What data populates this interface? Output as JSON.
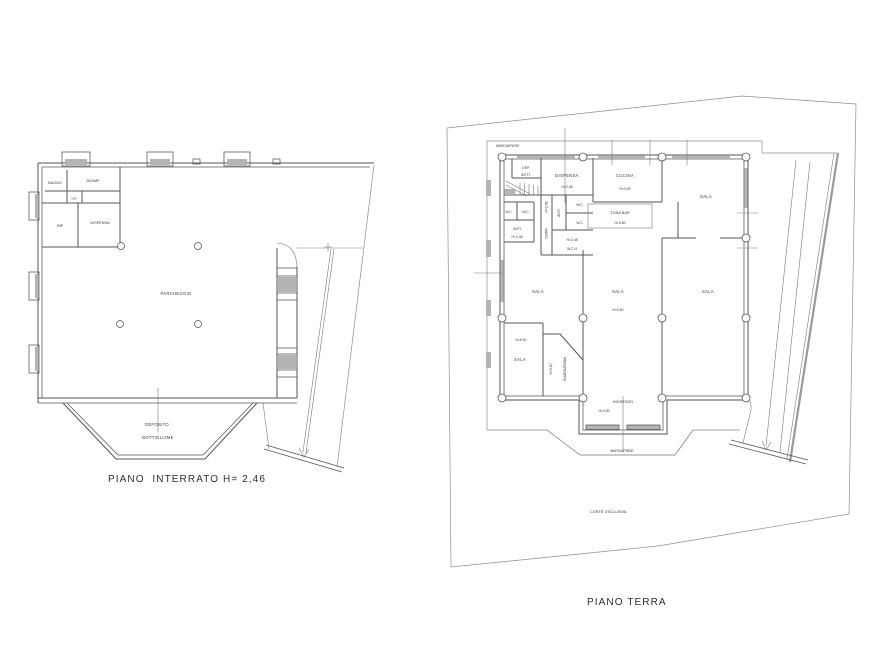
{
  "title": "Floor plan drawing",
  "colors": {
    "background": "#ffffff",
    "line": "#565656",
    "boundary": "#8f8f8f",
    "hatch_fill": "#b4b4b4",
    "text": "#383838"
  },
  "basement_plan": {
    "caption": "PIANO  INTERRATO H= 2,46",
    "rooms": {
      "bagno": "BAGNO",
      "disimp": "DISIMP",
      "dis": "DIS",
      "rip": "RIP",
      "dispensa": "DISPENSA",
      "parcheggio": "PARCHEGGIO",
      "deposito_line1": "DEPOSITO",
      "deposito_line2": "BOTTIGLIAME"
    }
  },
  "ground_plan": {
    "caption": "PIANO TERRA",
    "site": {
      "marciapiede_top": "MARCIAPIEDE",
      "marciapiede_bottom": "MARCIAPIEDE",
      "corte_esclusiva": "CORTE  ESCLUSIVA"
    },
    "rooms": {
      "dep_line1": "DEP.",
      "dep_line2": "BOTT.",
      "dispensa": "DISPENSA",
      "dispensa_h": "H=2,48",
      "cucina": "CUCINA",
      "cucina_h": "H=3,09",
      "sala_ne": "SALA",
      "zona_bar": "ZONA BAR",
      "zona_bar_h": "H=5,60",
      "wc_a": "W.C.",
      "wc_b": "W.C.",
      "wc_c": "W.C.",
      "wc_d": "W.C.",
      "anti_vertical": "ANTI",
      "corr_h": "H=2,48",
      "corr": "CORR.",
      "anti": "ANTI",
      "anti_h": "H=2,48",
      "wch_h": "H=2,48",
      "wch": "W.C.H",
      "sala_w": "SALA",
      "sala_c": "SALA",
      "sala_c_h": "H=5,60",
      "sala_e": "SALA",
      "sala_sw_h": "H=5,60",
      "sala_sw": "SALA",
      "guardaroba_h": "H=5,60",
      "guardaroba": "GUARDAROBA",
      "ingresso": "INGRESSO",
      "ingresso_h": "H=3,90"
    }
  }
}
